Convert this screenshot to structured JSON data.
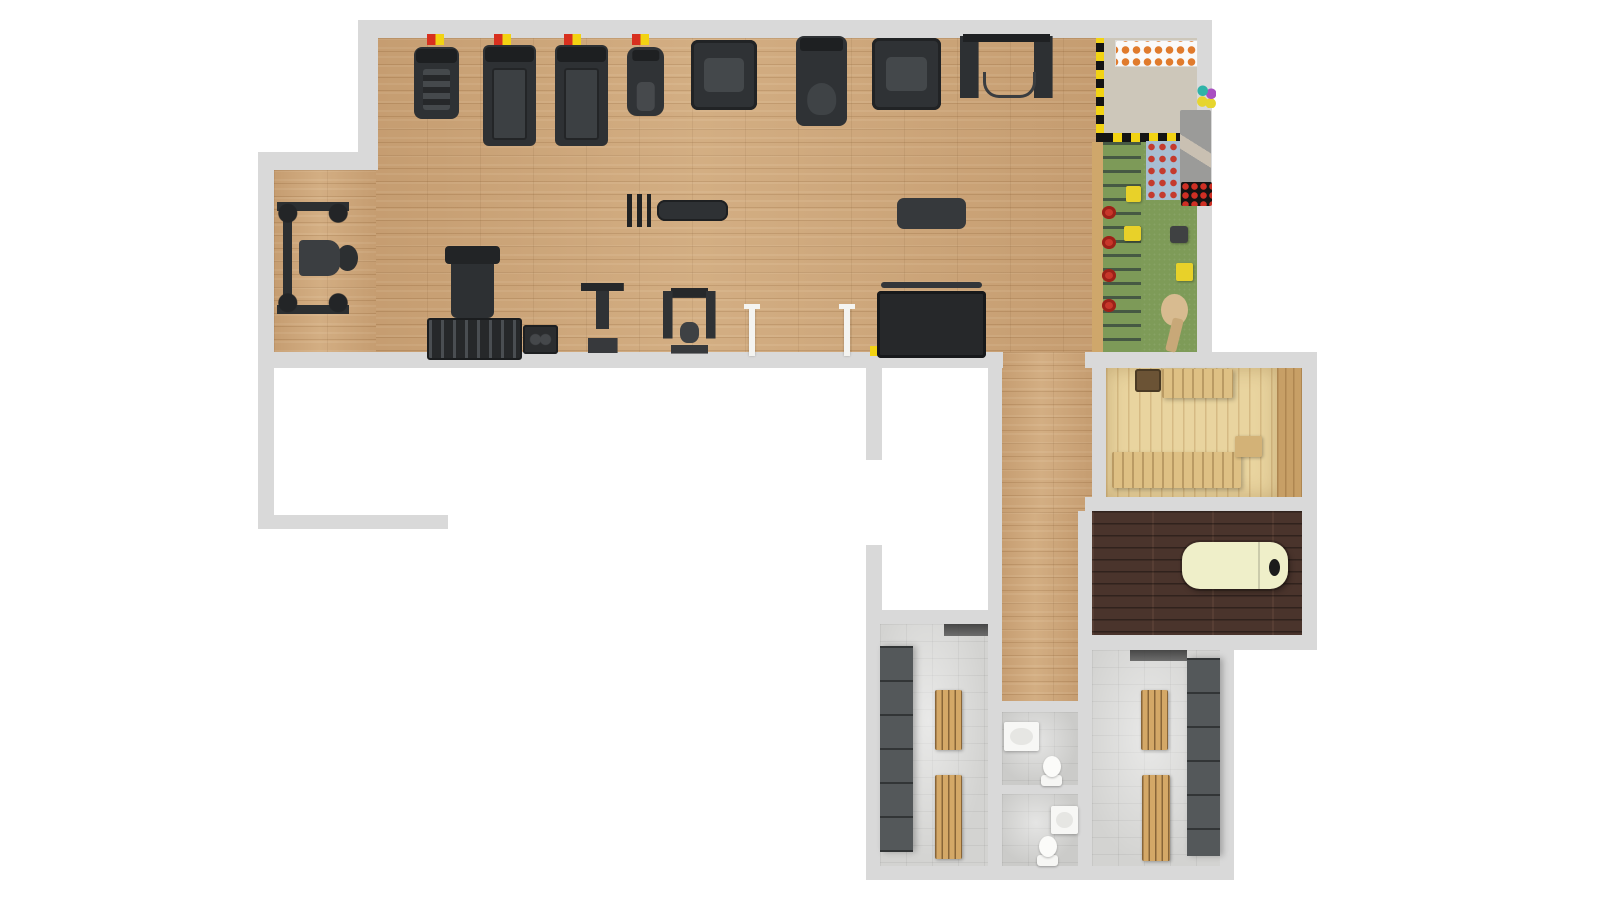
{
  "title": "gym-floor-plan-top-view",
  "canvas": {
    "width": 1600,
    "height": 900
  },
  "palette": {
    "wall": "#d9d9d9",
    "gym_wood": "#cda67a",
    "turf": "#7e9b58",
    "kids_beige": "#cdc7ba",
    "sauna_pine": "#e9d49f",
    "bench_pine": "#dec084",
    "vestibule_oak": "#c79f66",
    "walnut": "#4a342c",
    "tile": "#d3d3d1",
    "equipment_dark": "#2e3134",
    "locker_gray": "#54585a",
    "bench_oak": "#d4a867",
    "massage_cream": "#efefc9",
    "safety_red": "#d8301f",
    "safety_yellow": "#f2d313",
    "shelf_orange": "#e07b2d",
    "climb_blue": "#a8bed2"
  },
  "rooms": [
    {
      "name": "main-gym"
    },
    {
      "name": "kids-play-zone"
    },
    {
      "name": "sauna"
    },
    {
      "name": "sauna-vestibule"
    },
    {
      "name": "massage-room"
    },
    {
      "name": "corridor"
    },
    {
      "name": "locker-room-left"
    },
    {
      "name": "locker-room-right"
    },
    {
      "name": "wc-1"
    },
    {
      "name": "wc-2"
    },
    {
      "name": "empty-room-a"
    },
    {
      "name": "empty-room-b"
    }
  ],
  "elements": [
    {
      "name": "gym-floor-main",
      "type": "floor-wood",
      "x": 374,
      "y": 38,
      "w": 722,
      "h": 314
    },
    {
      "name": "gym-floor-left-wing",
      "type": "floor-wood",
      "x": 274,
      "y": 170,
      "w": 102,
      "h": 182
    },
    {
      "name": "corridor-floor-upper",
      "type": "floor-wood",
      "x": 1000,
      "y": 352,
      "w": 92,
      "h": 160
    },
    {
      "name": "corridor-floor-lower",
      "type": "floor-wood",
      "x": 1000,
      "y": 512,
      "w": 78,
      "h": 190
    },
    {
      "name": "kids-floor-upper",
      "type": "floor-beige",
      "x": 1104,
      "y": 38,
      "w": 93,
      "h": 104
    },
    {
      "name": "kids-floor-turf",
      "type": "floor-turf",
      "x": 1092,
      "y": 142,
      "w": 105,
      "h": 210
    },
    {
      "name": "sauna-floor",
      "type": "floor-sauna",
      "x": 1106,
      "y": 368,
      "w": 171,
      "h": 129
    },
    {
      "name": "sauna-vestibule-floor",
      "type": "floor-vest",
      "x": 1277,
      "y": 368,
      "w": 25,
      "h": 129
    },
    {
      "name": "massage-room-floor",
      "type": "floor-walnut",
      "x": 1092,
      "y": 511,
      "w": 210,
      "h": 124
    },
    {
      "name": "locker-left-floor",
      "type": "floor-tile",
      "x": 880,
      "y": 624,
      "w": 108,
      "h": 242
    },
    {
      "name": "locker-right-floor",
      "type": "floor-tile",
      "x": 1092,
      "y": 650,
      "w": 128,
      "h": 216
    },
    {
      "name": "wc1-floor",
      "type": "floor-tile2",
      "x": 1002,
      "y": 712,
      "w": 76,
      "h": 73
    },
    {
      "name": "wc2-floor",
      "type": "floor-tile2",
      "x": 1002,
      "y": 794,
      "w": 76,
      "h": 72
    },
    {
      "name": "wall-top",
      "type": "wall",
      "x": 358,
      "y": 20,
      "w": 854,
      "h": 18
    },
    {
      "name": "wall-left-upper",
      "type": "wall",
      "x": 358,
      "y": 20,
      "w": 20,
      "h": 150
    },
    {
      "name": "wall-notch",
      "type": "wall",
      "x": 258,
      "y": 152,
      "w": 120,
      "h": 18
    },
    {
      "name": "wall-left",
      "type": "wall",
      "x": 258,
      "y": 152,
      "w": 16,
      "h": 377
    },
    {
      "name": "wall-gym-bottom",
      "type": "wall",
      "x": 258,
      "y": 352,
      "w": 745,
      "h": 16
    },
    {
      "name": "wall-kids-right",
      "type": "wall",
      "x": 1197,
      "y": 20,
      "w": 15,
      "h": 348
    },
    {
      "name": "wall-sauna-top",
      "type": "wall",
      "x": 1085,
      "y": 352,
      "w": 232,
      "h": 16
    },
    {
      "name": "wall-right-outer",
      "type": "wall",
      "x": 1302,
      "y": 352,
      "w": 15,
      "h": 298
    },
    {
      "name": "wall-sauna-massage",
      "type": "wall",
      "x": 1085,
      "y": 497,
      "w": 232,
      "h": 14
    },
    {
      "name": "wall-sauna-left",
      "type": "wall",
      "x": 1092,
      "y": 368,
      "w": 14,
      "h": 143
    },
    {
      "name": "wall-massage-wc-left",
      "type": "wall",
      "x": 1078,
      "y": 511,
      "w": 14,
      "h": 355
    },
    {
      "name": "wall-massage-bottom",
      "type": "wall",
      "x": 1078,
      "y": 635,
      "w": 239,
      "h": 15
    },
    {
      "name": "wall-corridor-left",
      "type": "wall",
      "x": 988,
      "y": 368,
      "w": 14,
      "h": 244
    },
    {
      "name": "wall-locker-left-top",
      "type": "wall",
      "x": 866,
      "y": 610,
      "w": 136,
      "h": 14
    },
    {
      "name": "wall-locker-left-side",
      "type": "wall",
      "x": 866,
      "y": 610,
      "w": 14,
      "h": 270
    },
    {
      "name": "wall-bottom",
      "type": "wall",
      "x": 866,
      "y": 866,
      "w": 368,
      "h": 14
    },
    {
      "name": "wall-locker-wc-divider",
      "type": "wall",
      "x": 988,
      "y": 624,
      "w": 14,
      "h": 242
    },
    {
      "name": "wall-locker-right-side",
      "type": "wall",
      "x": 1220,
      "y": 650,
      "w": 14,
      "h": 230
    },
    {
      "name": "wall-wc-top",
      "type": "wall",
      "x": 1002,
      "y": 701,
      "w": 76,
      "h": 11
    },
    {
      "name": "wall-wc-divider",
      "type": "wall",
      "x": 1002,
      "y": 785,
      "w": 76,
      "h": 9
    },
    {
      "name": "wall-stub-a",
      "type": "wall",
      "x": 866,
      "y": 368,
      "w": 16,
      "h": 92
    },
    {
      "name": "wall-stub-b",
      "type": "wall",
      "x": 866,
      "y": 545,
      "w": 16,
      "h": 79
    },
    {
      "name": "wall-white-room-bottom",
      "type": "wall",
      "x": 258,
      "y": 515,
      "w": 190,
      "h": 14
    },
    {
      "name": "safety-marker-1",
      "type": "marker",
      "x": 427,
      "y": 34,
      "w": 17,
      "h": 11
    },
    {
      "name": "safety-marker-2",
      "type": "marker",
      "x": 494,
      "y": 34,
      "w": 17,
      "h": 11
    },
    {
      "name": "safety-marker-3",
      "type": "marker",
      "x": 564,
      "y": 34,
      "w": 17,
      "h": 11
    },
    {
      "name": "safety-marker-4",
      "type": "marker",
      "x": 632,
      "y": 34,
      "w": 17,
      "h": 11
    },
    {
      "name": "safety-marker-5",
      "type": "marker-rev",
      "x": 870,
      "y": 346,
      "w": 15,
      "h": 10
    },
    {
      "name": "stair-climber",
      "type": "stair",
      "x": 414,
      "y": 47,
      "w": 45,
      "h": 72
    },
    {
      "name": "treadmill-1",
      "type": "treadmill",
      "x": 483,
      "y": 45,
      "w": 53,
      "h": 101
    },
    {
      "name": "treadmill-2",
      "type": "treadmill",
      "x": 555,
      "y": 45,
      "w": 53,
      "h": 101
    },
    {
      "name": "elliptical-trainer",
      "type": "elliptical",
      "x": 627,
      "y": 47,
      "w": 37,
      "h": 69
    },
    {
      "name": "leg-press-machine",
      "type": "machine",
      "x": 691,
      "y": 40,
      "w": 66,
      "h": 70
    },
    {
      "name": "exercise-bike",
      "type": "bike",
      "x": 796,
      "y": 36,
      "w": 51,
      "h": 90
    },
    {
      "name": "shoulder-press-machine",
      "type": "machine",
      "x": 872,
      "y": 38,
      "w": 69,
      "h": 72
    },
    {
      "name": "cable-crossover",
      "type": "crossover",
      "x": 960,
      "y": 34,
      "w": 93,
      "h": 76
    },
    {
      "name": "smith-machine",
      "type": "smith",
      "x": 277,
      "y": 202,
      "w": 72,
      "h": 112
    },
    {
      "name": "flat-bench-with-dumbbells",
      "type": "flatbench",
      "x": 627,
      "y": 191,
      "w": 101,
      "h": 39
    },
    {
      "name": "exercise-mat",
      "type": "mat",
      "x": 897,
      "y": 198,
      "w": 69,
      "h": 31
    },
    {
      "name": "adjustable-bench",
      "type": "vbench",
      "x": 451,
      "y": 249,
      "w": 43,
      "h": 69
    },
    {
      "name": "dumbbell-rack",
      "type": "dbrack",
      "x": 427,
      "y": 318,
      "w": 91,
      "h": 38
    },
    {
      "name": "plate-rack",
      "type": "platerack",
      "x": 523,
      "y": 325,
      "w": 35,
      "h": 29
    },
    {
      "name": "dip-station",
      "type": "dip",
      "x": 577,
      "y": 283,
      "w": 51,
      "h": 70
    },
    {
      "name": "roman-chair",
      "type": "roman",
      "x": 663,
      "y": 288,
      "w": 53,
      "h": 66
    },
    {
      "name": "storage-ball-rack",
      "type": "ballrack",
      "x": 877,
      "y": 291,
      "w": 109,
      "h": 67
    },
    {
      "name": "partition-pole-1",
      "type": "pole",
      "x": 749,
      "y": 306,
      "w": 6,
      "h": 50
    },
    {
      "name": "partition-pole-2",
      "type": "pole",
      "x": 844,
      "y": 306,
      "w": 6,
      "h": 50
    },
    {
      "name": "kids-fence-vertical",
      "type": "fencev",
      "x": 1096,
      "y": 38,
      "w": 8,
      "h": 104
    },
    {
      "name": "kids-fence-horizontal",
      "type": "fenceh",
      "x": 1104,
      "y": 133,
      "w": 77,
      "h": 9
    },
    {
      "name": "kids-frame-beam",
      "type": "beam",
      "x": 1092,
      "y": 142,
      "w": 11,
      "h": 210
    },
    {
      "name": "kids-shoe-shelf",
      "type": "shelf",
      "x": 1115,
      "y": 40,
      "w": 81,
      "h": 25
    },
    {
      "name": "kids-play-balls",
      "type": "balls",
      "x": 1197,
      "y": 85,
      "w": 19,
      "h": 23
    },
    {
      "name": "kids-slide",
      "type": "slide",
      "x": 1180,
      "y": 110,
      "w": 31,
      "h": 84
    },
    {
      "name": "kids-climbing-wall",
      "type": "climbwall",
      "x": 1146,
      "y": 141,
      "w": 34,
      "h": 59
    },
    {
      "name": "kids-ball-pit",
      "type": "ballpit",
      "x": 1181,
      "y": 182,
      "w": 31,
      "h": 24
    },
    {
      "name": "kids-climb-ladder",
      "type": "ladder",
      "x": 1103,
      "y": 142,
      "w": 38,
      "h": 210
    },
    {
      "name": "kids-yellow-block-1",
      "type": "kblock-y",
      "x": 1126,
      "y": 186,
      "w": 15,
      "h": 16
    },
    {
      "name": "kids-yellow-block-2",
      "type": "kblock-y",
      "x": 1124,
      "y": 226,
      "w": 17,
      "h": 15
    },
    {
      "name": "kids-red-wheel-1",
      "type": "kwheel",
      "x": 1102,
      "y": 206,
      "w": 14,
      "h": 13
    },
    {
      "name": "kids-red-wheel-2",
      "type": "kwheel",
      "x": 1102,
      "y": 236,
      "w": 14,
      "h": 13
    },
    {
      "name": "kids-red-wheel-3",
      "type": "kwheel",
      "x": 1102,
      "y": 269,
      "w": 14,
      "h": 13
    },
    {
      "name": "kids-red-wheel-4",
      "type": "kwheel",
      "x": 1102,
      "y": 299,
      "w": 14,
      "h": 13
    },
    {
      "name": "kids-dark-cube",
      "type": "kblock-dark",
      "x": 1170,
      "y": 226,
      "w": 18,
      "h": 17
    },
    {
      "name": "kids-yellow-cube",
      "type": "kblock-y",
      "x": 1176,
      "y": 263,
      "w": 17,
      "h": 18
    },
    {
      "name": "kids-play-tree",
      "type": "ktree",
      "x": 1157,
      "y": 294,
      "w": 35,
      "h": 58
    },
    {
      "name": "sauna-bench-lower",
      "type": "sbench",
      "x": 1112,
      "y": 452,
      "w": 129,
      "h": 36
    },
    {
      "name": "sauna-bench-upper",
      "type": "sbench",
      "x": 1162,
      "y": 369,
      "w": 71,
      "h": 29
    },
    {
      "name": "sauna-heater",
      "type": "sheater",
      "x": 1135,
      "y": 369,
      "w": 26,
      "h": 23
    },
    {
      "name": "sauna-step",
      "type": "sstep",
      "x": 1235,
      "y": 436,
      "w": 27,
      "h": 21
    },
    {
      "name": "massage-table",
      "type": "mtable",
      "x": 1182,
      "y": 542,
      "w": 106,
      "h": 47
    },
    {
      "name": "lockers-left",
      "type": "lockers",
      "x": 880,
      "y": 646,
      "w": 33,
      "h": 206
    },
    {
      "name": "locker-left-bench-1",
      "type": "wbench",
      "x": 935,
      "y": 690,
      "w": 27,
      "h": 60
    },
    {
      "name": "locker-left-bench-2",
      "type": "wbench",
      "x": 935,
      "y": 775,
      "w": 27,
      "h": 84
    },
    {
      "name": "locker-left-shelf",
      "type": "shadowstrip",
      "x": 944,
      "y": 624,
      "w": 44,
      "h": 12
    },
    {
      "name": "lockers-right",
      "type": "lockers",
      "x": 1187,
      "y": 658,
      "w": 33,
      "h": 198
    },
    {
      "name": "locker-right-bench-1",
      "type": "wbench",
      "x": 1141,
      "y": 690,
      "w": 27,
      "h": 60
    },
    {
      "name": "locker-right-bench-2",
      "type": "wbench",
      "x": 1142,
      "y": 775,
      "w": 28,
      "h": 86
    },
    {
      "name": "locker-right-shelf",
      "type": "shadowstrip",
      "x": 1130,
      "y": 650,
      "w": 57,
      "h": 11
    },
    {
      "name": "wc1-sink",
      "type": "sink",
      "x": 1004,
      "y": 722,
      "w": 35,
      "h": 29
    },
    {
      "name": "wc1-toilet",
      "type": "toilet",
      "x": 1039,
      "y": 756,
      "w": 25,
      "h": 30
    },
    {
      "name": "wc2-sink",
      "type": "sink",
      "x": 1051,
      "y": 806,
      "w": 27,
      "h": 28
    },
    {
      "name": "wc2-toilet",
      "type": "toilet",
      "x": 1035,
      "y": 836,
      "w": 25,
      "h": 30
    }
  ]
}
